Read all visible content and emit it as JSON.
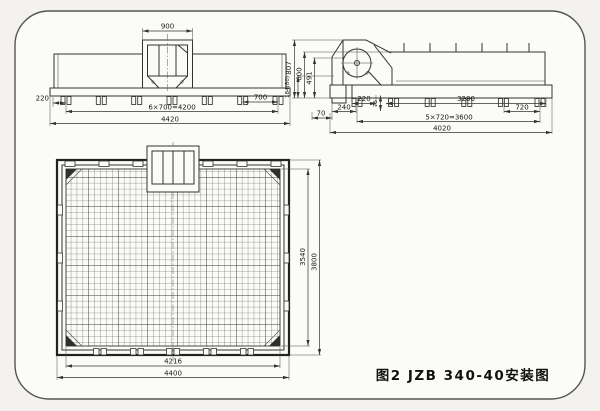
{
  "figure": {
    "caption": "图2 JZB 340-40安装图",
    "line_color": "#333333",
    "paper_color": "#fbfbf8",
    "background_color": "#f3f2ee"
  },
  "front_view": {
    "dim_feed_box_width": "900",
    "dim_left_offset": "220",
    "dim_foot_spacing": "700",
    "dim_foot_pitch_total": "6×700=4200",
    "dim_overall_width": "4420"
  },
  "side_view": {
    "dim_height_overall": "807",
    "dim_height_wall": "600",
    "dim_height_discharge": "491",
    "dim_height_base": "184(80)",
    "dim_offset_220": "220",
    "dim_offset_75": "75",
    "dim_span_3280": "3280",
    "dim_offset_240": "240",
    "dim_offset_70": "70",
    "dim_foot_spacing": "720",
    "dim_foot_pitch_total": "5×720=3600",
    "dim_overall_length": "4020"
  },
  "plan_view": {
    "dim_mesh_height": "3540",
    "dim_overall_height": "3800",
    "dim_mesh_width": "4216",
    "dim_overall_width": "4400"
  }
}
